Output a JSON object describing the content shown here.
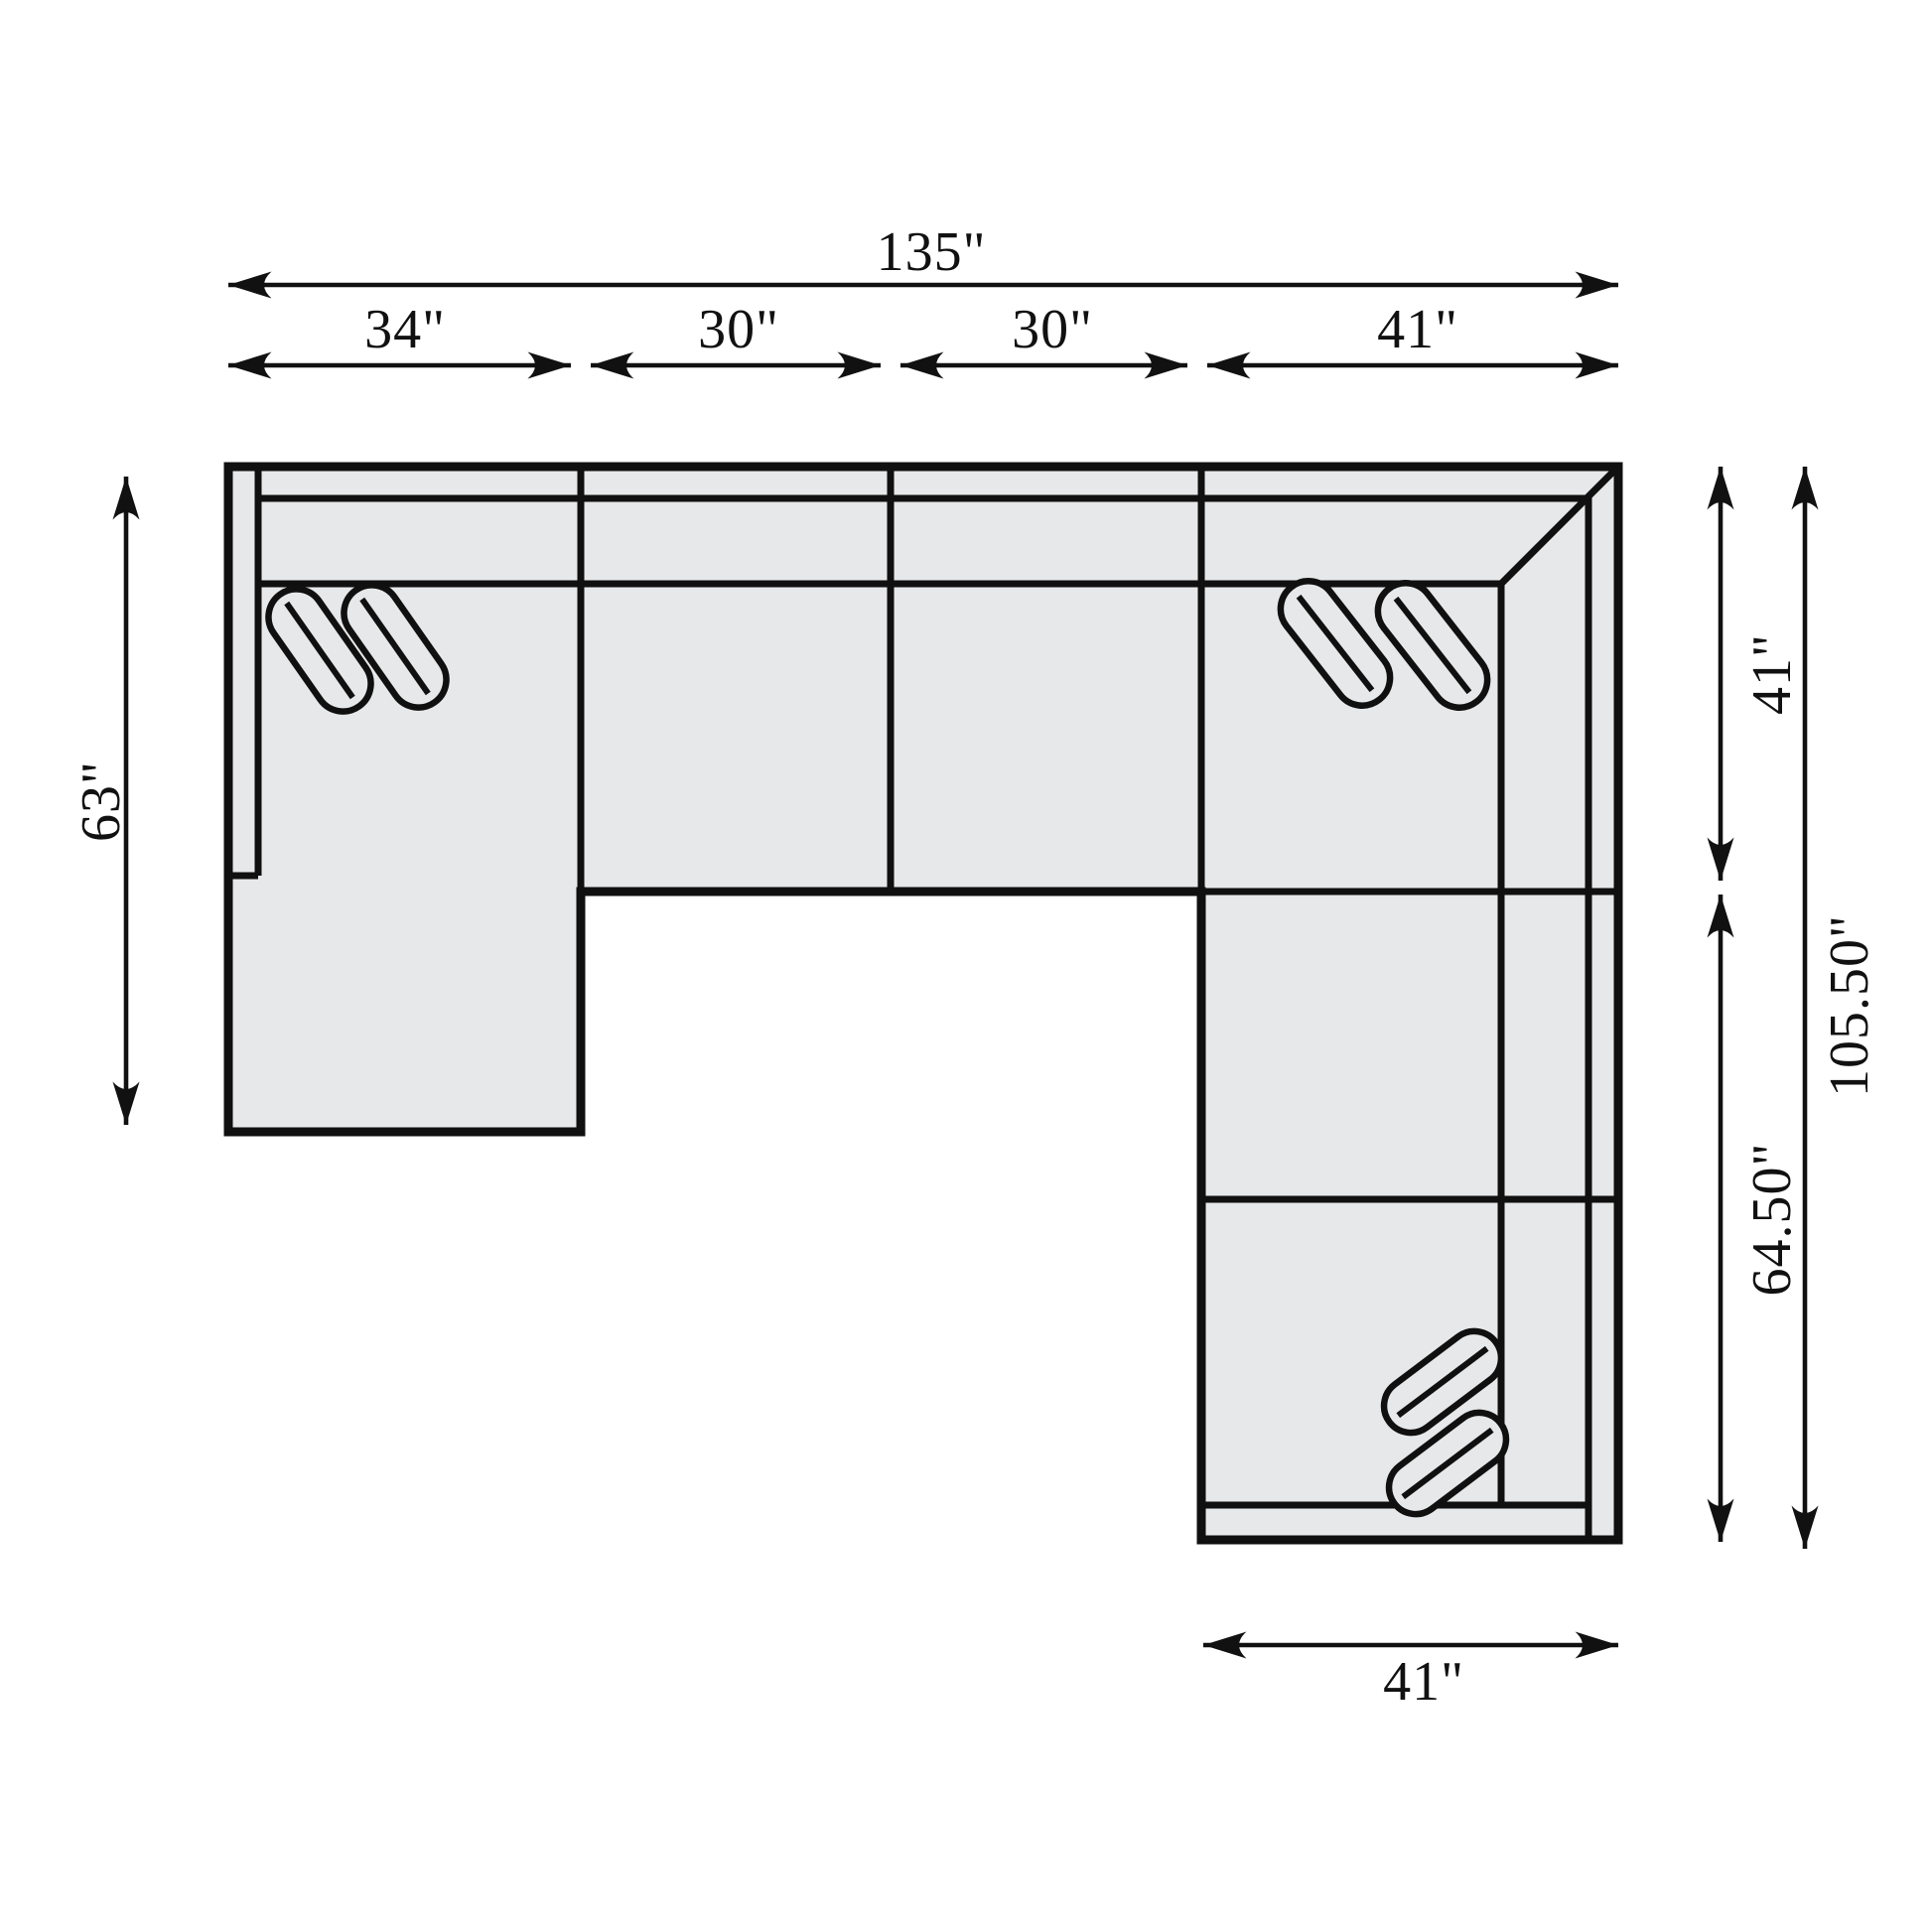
{
  "diagram": {
    "type": "sectional-sofa-dimension-plan",
    "labels": {
      "overall_width": "135\"",
      "seg1": "34\"",
      "seg2": "30\"",
      "seg3": "30\"",
      "seg4": "41\"",
      "left_height": "63\"",
      "right_upper": "41\"",
      "right_lower": "64.50\"",
      "right_total": "105.50\"",
      "bottom_width": "41\""
    },
    "values_inches": {
      "overall_width": 135,
      "top_segments": [
        34,
        30,
        30,
        41
      ],
      "left_height": 63,
      "right_upper": 41,
      "right_lower": 64.5,
      "right_total": 105.5,
      "bottom_width": 41
    },
    "colors": {
      "line": "#111111",
      "sofa_fill": "#e7e8e9",
      "background": "#ffffff"
    }
  }
}
